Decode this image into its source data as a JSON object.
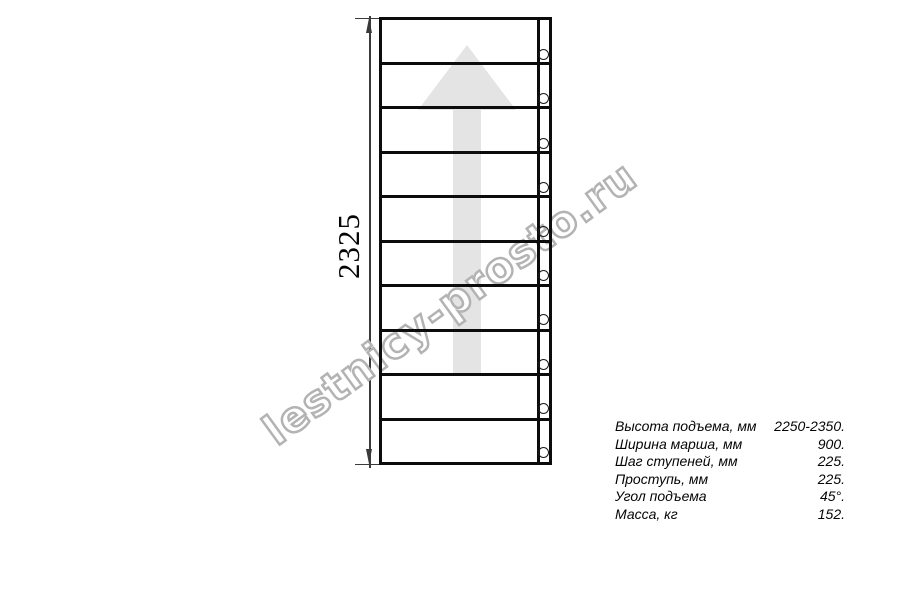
{
  "watermark": {
    "text": "lestnicy-prosto.ru"
  },
  "drawing": {
    "dimension_label": "2325",
    "steps_count": 10,
    "bolts_count": 10
  },
  "specs": {
    "rows": [
      {
        "label": "Высота подъема, мм",
        "value": "2250-2350."
      },
      {
        "label": "Ширина марша, мм",
        "value": "900."
      },
      {
        "label": "Шаг ступеней, мм",
        "value": "225."
      },
      {
        "label": "Проступь, мм",
        "value": "225."
      },
      {
        "label": "Угол подъема",
        "value": "45°."
      },
      {
        "label": "Масса, кг",
        "value": "152."
      }
    ]
  },
  "colors": {
    "line": "#0c0c0c",
    "dimension": "#3a3a3a",
    "arrow_fill": "#e4e4e4",
    "watermark_outline": "#b3b3b3"
  }
}
